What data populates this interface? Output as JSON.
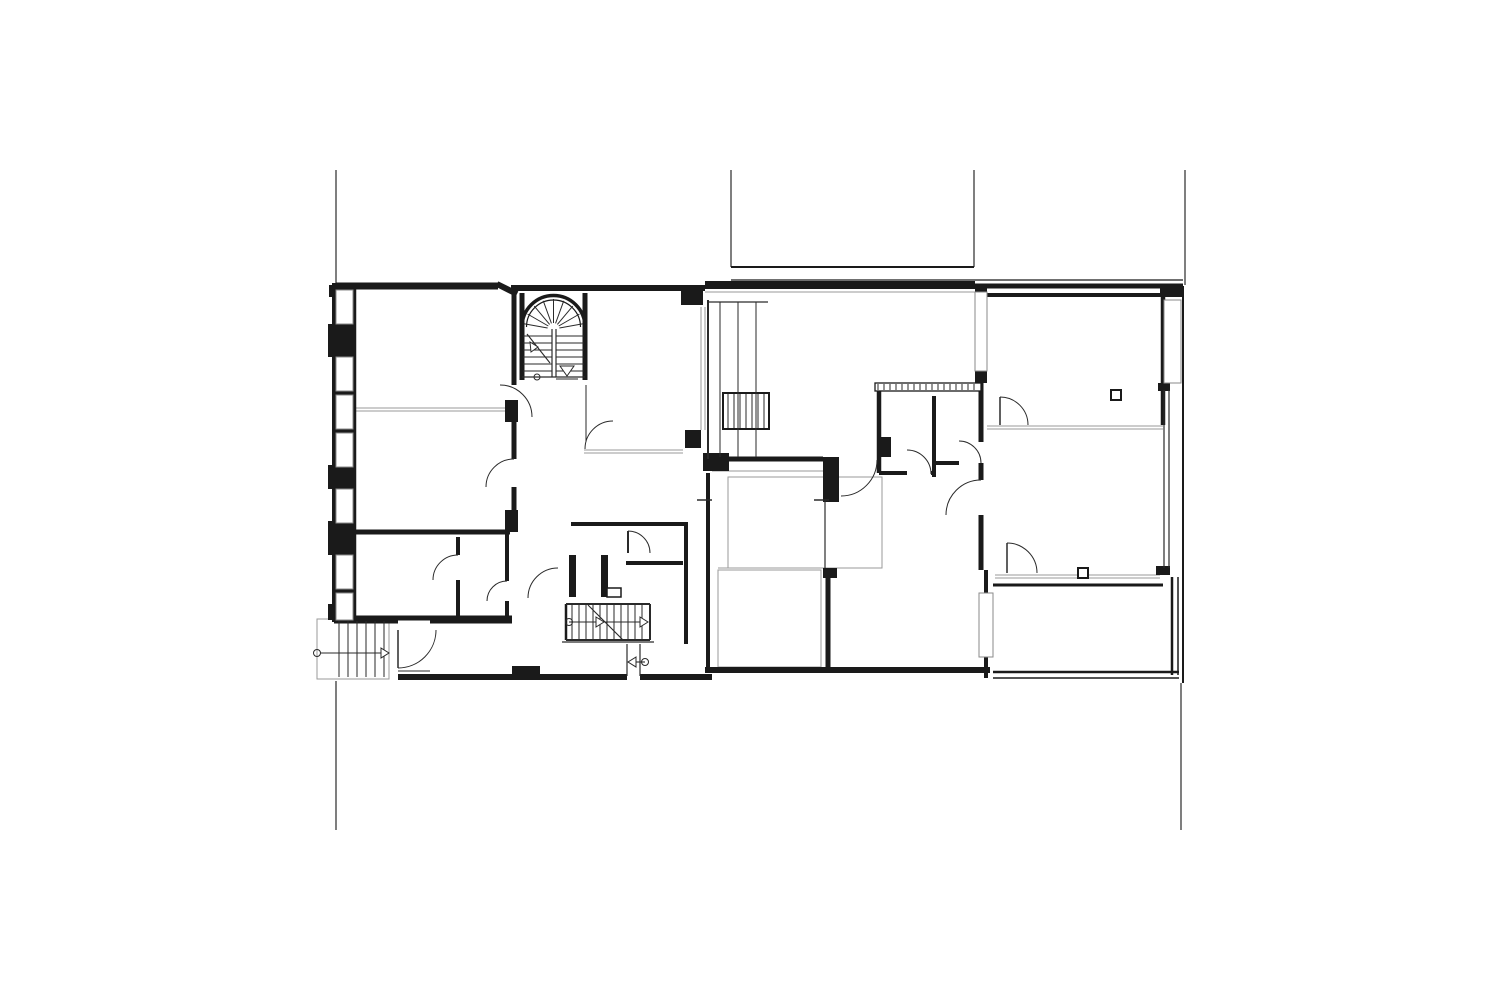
{
  "meta": {
    "canvas": {
      "width": 1500,
      "height": 1000,
      "background": "#ffffff"
    }
  },
  "palette": {
    "wall": "#1a1a1a",
    "thin": "#2a2a2a",
    "gray": "#9a9a9a",
    "site": "#3a3a3a",
    "white": "#ffffff"
  },
  "plan": {
    "site_lines": [
      [
        336,
        170,
        336,
        288
      ],
      [
        731,
        170,
        731,
        267
      ],
      [
        974,
        170,
        974,
        267
      ],
      [
        1185,
        170,
        1185,
        285
      ],
      [
        336,
        681,
        336,
        830
      ],
      [
        1181,
        683,
        1181,
        830
      ]
    ],
    "walls_thick": [
      [
        336,
        286,
        498,
        286,
        7
      ],
      [
        497,
        284,
        517,
        294,
        6
      ],
      [
        511,
        288,
        705,
        288,
        6
      ],
      [
        705,
        285,
        975,
        285,
        8
      ],
      [
        975,
        286,
        1183,
        286,
        5
      ],
      [
        987,
        295,
        1160,
        295,
        4
      ],
      [
        334,
        283,
        334,
        622,
        4
      ],
      [
        355,
        289,
        355,
        618,
        2.5
      ],
      [
        334,
        620,
        398,
        620,
        7
      ],
      [
        430,
        620,
        512,
        620,
        7
      ],
      [
        398,
        677,
        627,
        677,
        6
      ],
      [
        640,
        677,
        712,
        677,
        6
      ],
      [
        705,
        670,
        990,
        670,
        6
      ],
      [
        514,
        294,
        514,
        385,
        5
      ],
      [
        514,
        417,
        514,
        459,
        5
      ],
      [
        514,
        487,
        514,
        532,
        5
      ],
      [
        522,
        293,
        522,
        380,
        5
      ],
      [
        585,
        293,
        585,
        380,
        5
      ],
      [
        336,
        532,
        510,
        532,
        5
      ],
      [
        458,
        537,
        458,
        555,
        4
      ],
      [
        458,
        580,
        458,
        618,
        4
      ],
      [
        507,
        532,
        507,
        581,
        4
      ],
      [
        507,
        601,
        507,
        618,
        4
      ],
      [
        355,
        618,
        512,
        618,
        5
      ],
      [
        571,
        524,
        686,
        524,
        4
      ],
      [
        626,
        563,
        683,
        563,
        4
      ],
      [
        686,
        522,
        686,
        644,
        4
      ],
      [
        708,
        459,
        823,
        459,
        5
      ],
      [
        879,
        388,
        879,
        473,
        4.5
      ],
      [
        934,
        396,
        934,
        477,
        4
      ],
      [
        879,
        473,
        907,
        473,
        4
      ],
      [
        931,
        473,
        934,
        473,
        4
      ],
      [
        934,
        463,
        959,
        463,
        4
      ],
      [
        981,
        371,
        981,
        442,
        5
      ],
      [
        981,
        463,
        981,
        480,
        5
      ],
      [
        981,
        515,
        981,
        570,
        5
      ],
      [
        1163,
        296,
        1163,
        425,
        4.5
      ],
      [
        993,
        585,
        1163,
        585,
        3
      ],
      [
        1172,
        577,
        1172,
        675,
        2.5
      ],
      [
        1178,
        577,
        1178,
        675,
        1.5
      ],
      [
        993,
        672,
        1179,
        672,
        2.5
      ],
      [
        993,
        678,
        1179,
        678,
        1.5
      ],
      [
        828,
        575,
        828,
        670,
        5
      ],
      [
        708,
        473,
        708,
        670,
        4
      ],
      [
        566,
        604,
        566,
        640,
        2.5
      ],
      [
        986,
        570,
        986,
        593,
        4
      ],
      [
        986,
        657,
        986,
        678,
        4
      ],
      [
        1183,
        286,
        1183,
        683,
        2
      ],
      [
        731,
        267,
        974,
        267,
        2
      ],
      [
        731,
        280,
        1183,
        280,
        1.3
      ]
    ],
    "rects_dark": [
      [
        681,
        285,
        22,
        20
      ],
      [
        703,
        453,
        26,
        18
      ],
      [
        685,
        430,
        16,
        18
      ],
      [
        823,
        457,
        16,
        45
      ],
      [
        505,
        400,
        13,
        22
      ],
      [
        505,
        510,
        13,
        22
      ],
      [
        512,
        666,
        28,
        12
      ],
      [
        975,
        285,
        12,
        9
      ],
      [
        975,
        371,
        12,
        12
      ],
      [
        1160,
        286,
        23,
        11
      ],
      [
        1158,
        383,
        12,
        8
      ],
      [
        1156,
        566,
        14,
        9
      ],
      [
        878,
        437,
        13,
        20
      ],
      [
        823,
        568,
        14,
        10
      ],
      [
        334,
        283,
        22,
        339
      ],
      [
        329,
        285,
        6,
        12
      ],
      [
        328,
        324,
        7,
        33
      ],
      [
        328,
        465,
        7,
        24
      ],
      [
        328,
        521,
        7,
        34
      ],
      [
        328,
        604,
        7,
        16
      ],
      [
        569,
        555,
        7,
        42
      ],
      [
        601,
        555,
        7,
        42
      ]
    ],
    "rects_white": [
      [
        336,
        290,
        17,
        34
      ],
      [
        336,
        357,
        17,
        34
      ],
      [
        336,
        395,
        17,
        34
      ],
      [
        336,
        433,
        17,
        34
      ],
      [
        336,
        489,
        17,
        34
      ],
      [
        336,
        555,
        17,
        34
      ],
      [
        336,
        593,
        17,
        27
      ],
      [
        975,
        292,
        12,
        79
      ],
      [
        1164,
        300,
        17,
        83
      ],
      [
        979,
        593,
        14,
        64
      ]
    ],
    "rects_outline": [
      [
        1111,
        390,
        10,
        10,
        2
      ],
      [
        1078,
        568,
        10,
        10,
        2
      ],
      [
        723,
        393,
        46,
        36,
        2
      ],
      [
        607,
        588,
        14,
        9,
        1.5
      ],
      [
        875,
        383,
        106,
        8,
        1.3
      ]
    ],
    "rects_gray": [
      [
        728,
        477,
        154,
        91
      ],
      [
        718,
        570,
        103,
        97
      ],
      [
        317,
        619,
        72,
        60
      ]
    ],
    "lines_thin": [
      [
        566,
        604,
        650,
        604,
        2
      ],
      [
        566,
        640,
        650,
        640,
        2
      ],
      [
        650,
        604,
        650,
        640,
        2
      ],
      [
        562,
        642,
        654,
        642,
        1.2
      ],
      [
        522,
        377,
        585,
        377,
        1.3
      ],
      [
        398,
        671,
        430,
        671,
        1
      ],
      [
        627,
        644,
        627,
        676,
        1.2
      ],
      [
        640,
        644,
        640,
        676,
        1.2
      ],
      [
        825,
        500,
        825,
        568,
        1.2
      ],
      [
        628,
        531,
        628,
        553,
        2
      ],
      [
        1000,
        397,
        1000,
        425,
        1.5
      ],
      [
        1007,
        543,
        1007,
        573,
        1.5
      ],
      [
        398,
        630,
        398,
        668,
        1.5
      ],
      [
        708,
        300,
        708,
        459,
        2
      ],
      [
        708,
        302,
        768,
        302,
        1.2
      ],
      [
        552,
        329,
        552,
        377,
        1.2
      ],
      [
        556,
        329,
        556,
        377,
        1.2
      ],
      [
        1164,
        390,
        1164,
        568,
        1.2
      ],
      [
        1169,
        390,
        1169,
        568,
        1.2
      ],
      [
        586,
        385,
        586,
        442,
        1
      ],
      [
        697,
        500,
        712,
        500,
        1.5
      ],
      [
        814,
        500,
        829,
        500,
        1.5
      ]
    ],
    "lines_gray": [
      [
        356,
        408,
        510,
        408
      ],
      [
        356,
        411,
        510,
        411
      ],
      [
        584,
        450,
        683,
        450
      ],
      [
        584,
        453,
        683,
        453
      ],
      [
        987,
        426,
        1163,
        426
      ],
      [
        987,
        429,
        1163,
        429
      ],
      [
        995,
        575,
        1160,
        575
      ],
      [
        995,
        578,
        1160,
        578
      ],
      [
        705,
        292,
        975,
        292
      ],
      [
        712,
        471,
        823,
        471
      ],
      [
        701,
        307,
        701,
        430
      ],
      [
        705,
        307,
        705,
        430
      ],
      [
        718,
        568,
        881,
        568
      ]
    ],
    "door_arcs": [
      [
        500,
        417,
        32,
        270,
        360
      ],
      [
        514,
        487,
        28,
        180,
        270
      ],
      [
        458,
        580,
        25,
        180,
        270
      ],
      [
        507,
        601,
        20,
        180,
        270
      ],
      [
        398,
        630,
        38,
        0,
        90
      ],
      [
        558,
        598,
        30,
        180,
        270
      ],
      [
        628,
        553,
        22,
        270,
        360
      ],
      [
        613,
        449,
        28,
        180,
        270
      ],
      [
        841,
        460,
        36,
        0,
        90
      ],
      [
        907,
        474,
        24,
        270,
        360
      ],
      [
        959,
        463,
        22,
        270,
        360
      ],
      [
        1000,
        425,
        28,
        270,
        360
      ],
      [
        981,
        515,
        35,
        180,
        270
      ],
      [
        1007,
        573,
        30,
        270,
        360
      ]
    ],
    "circles": [
      [
        317,
        653,
        3.5
      ],
      [
        569,
        622,
        3.5
      ],
      [
        645,
        662,
        3.5
      ],
      [
        537,
        377,
        3
      ]
    ],
    "triangles": [
      [
        381,
        648,
        389,
        653,
        381,
        658
      ],
      [
        596,
        617,
        604,
        622,
        596,
        627
      ],
      [
        640,
        617,
        648,
        622,
        640,
        627
      ],
      [
        636,
        657,
        628,
        662,
        636,
        667
      ],
      [
        560,
        366,
        574,
        366,
        567,
        376
      ],
      [
        530,
        342,
        538,
        347,
        531,
        352
      ]
    ],
    "arrow_lines": [
      [
        320,
        653,
        386,
        653
      ],
      [
        569,
        622,
        646,
        622
      ],
      [
        629,
        662,
        645,
        662
      ],
      [
        556,
        379,
        578,
        379
      ],
      [
        527,
        334,
        550,
        363
      ],
      [
        588,
        605,
        623,
        640
      ]
    ],
    "tread_groups": [
      {
        "dir": "v",
        "o": 339,
        "step": 9,
        "n": 6,
        "a": 621,
        "b": 677
      },
      {
        "dir": "v",
        "o": 572,
        "step": 7,
        "n": 11,
        "a": 605,
        "b": 639
      },
      {
        "dir": "v",
        "o": 728,
        "step": 6,
        "n": 7,
        "a": 394,
        "b": 428
      },
      {
        "dir": "h",
        "o": 336,
        "step": 7,
        "n": 6,
        "a": 523,
        "b": 552
      },
      {
        "dir": "h",
        "o": 336,
        "step": 7,
        "n": 6,
        "a": 556,
        "b": 584
      },
      {
        "dir": "v",
        "o": 720,
        "step": 18,
        "n": 3,
        "a": 302,
        "b": 457
      },
      {
        "dir": "v",
        "o": 878,
        "step": 6,
        "n": 17,
        "a": 384,
        "b": 390
      }
    ],
    "winder_fan": {
      "cx": 553.5,
      "cy": 329,
      "r1": 6,
      "r2": 30,
      "a1": 190,
      "a2": 350,
      "n": 9
    },
    "winder_arch": {
      "cx": 553.5,
      "cy": 327,
      "r_out": 31.5,
      "r_in": 27
    }
  }
}
